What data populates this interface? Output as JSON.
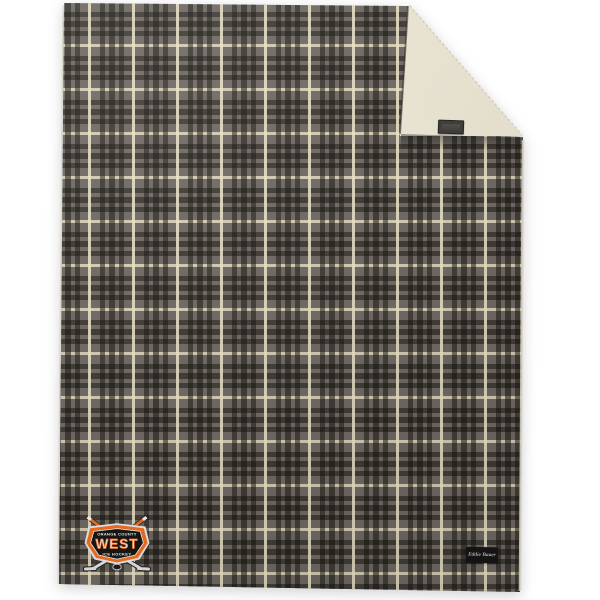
{
  "product": {
    "description": "gray plaid fleece blanket with folded sherpa corner",
    "logo_badge": {
      "top_text": "ORANGE COUNTY",
      "main_text": "WEST",
      "bottom_text": "ICE HOCKEY"
    },
    "brand_label": {
      "text": "Eddie Bauer"
    },
    "colors": {
      "background": "#ffffff",
      "plaid_base": "#6e6862",
      "plaid_dark": "#332f2a",
      "plaid_cream": "#e7dfc1",
      "sherpa_light": "#efead9",
      "sherpa_shade": "#d8d2bd",
      "badge_orange": "#e56920",
      "badge_dark": "#161614",
      "badge_silver": "#e2e2e2",
      "label_bg": "#141414",
      "label_text": "#e6e6e6",
      "tag_bg": "#403e3a"
    }
  }
}
